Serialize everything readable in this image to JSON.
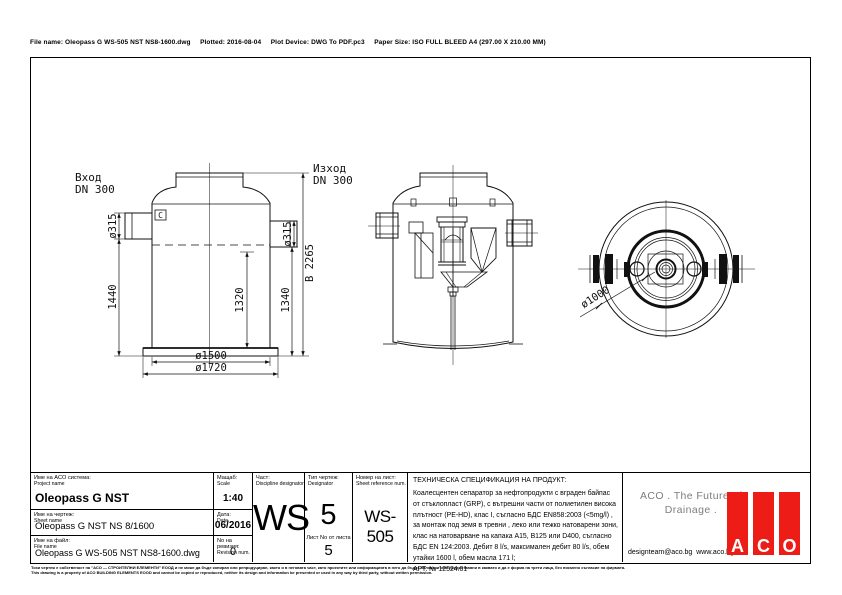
{
  "header": {
    "file_info": "File name: Oleopass G WS-505 NST NS8-1600.dwg     Plotted: 2016-08-04     Plot Device: DWG To PDF.pc3     Paper Size: ISO FULL BLEED A4 (297.00 X 210.00 MM)"
  },
  "drawing": {
    "front_view": {
      "inlet_label": "Вход",
      "inlet_dn": "DN 300",
      "outlet_label": "Изход",
      "outlet_dn": "DN 300",
      "dim_inlet_dia": "ø315",
      "dim_outlet_dia": "ø315",
      "dim_1440": "1440",
      "dim_1320": "1320",
      "dim_1340": "1340",
      "dim_total_height": "В 2265",
      "dim_inner_dia": "ø1500",
      "dim_outer_dia": "ø1720",
      "marker": "C"
    },
    "top_view": {
      "dim_dia": "ø1000"
    }
  },
  "title_block": {
    "project": {
      "label_bg": "Име на ACO система:",
      "label_en": "Project name",
      "value": "Oleopass G NST"
    },
    "sheet": {
      "label_bg": "Име на чертеж:",
      "label_en": "Sheet name",
      "value": "Oleopass G NST NS 8/1600"
    },
    "file": {
      "label_bg": "Име на файл:",
      "label_en": "File name",
      "value": "Oleopass G WS-505 NST NS8-1600.dwg"
    },
    "scale": {
      "label_bg": "Мащаб:",
      "label_en": "Scale",
      "value": "1:40"
    },
    "date": {
      "label_bg": "Дата:",
      "label_en": "Date",
      "value": "06/2016"
    },
    "revision": {
      "label_bg": "No на ревизия:",
      "label_en": "Revision num.",
      "value": "0"
    },
    "discipline": {
      "label_bg": "Част:",
      "label_en": "Discipline designator",
      "value": "WS"
    },
    "type": {
      "label_bg": "Тип чертеж:",
      "label_en": "Designator",
      "value": "5",
      "sheet_of_label": "Лист No от листа",
      "sheet_of_value": "5"
    },
    "sheet_ref": {
      "label_bg": "Номер на лист:",
      "label_en": "Sheet reference num.",
      "value": "WS-505"
    },
    "spec": {
      "title": "ТЕХНИЧЕСКА СПЕЦИФИКАЦИЯ НА ПРОДУКТ:",
      "body": "Коалесцентен сепаратор за нефтопродукти с вграден байпас от стъклопласт (GRP), с вътрешни части от полиетилен висока плътност (PE-HD), клас I, съгласно БДС EN858:2003 (<5mg/l) , за монтаж под земя в тревни , леко или тежко натоварени зони, клас на натоварване на капака A15, B125 или D400, съгласно БДС EN 124:2003. Дебит 8 l/s, максимален дебит 80 l/s, обем утайки 1600 l, обем масла 171 l;",
      "art": "АРТ. № 12524.01"
    },
    "brand": {
      "slogan_line1": "ACO . The Future of",
      "slogan_line2": "Drainage .",
      "contacts": "designteam@aco.bg  www.aco.bg",
      "logo_letters": [
        "A",
        "C",
        "O"
      ],
      "logo_color": "#ed1c16",
      "slogan_color": "#7d7d7d"
    }
  },
  "footer": {
    "disclaimer_bg": "Този чертеж е собственост на \"АСО — СТРОИТЕЛНИ ЕЛЕМЕНТИ\" ЕООД и не може да бъде копиран или репродуциран, както и в неговата част, като проектите или информацията в него да бъдат ползвани или предоставяни в каквато и да е форма на трети лица, без писмено съгласие на фирмата.",
    "disclaimer_en": "This drawing is a property of ACO BUILDING ELEMENTS EOOD and cannot be copied or reproduced, neither its design and information be presented or used in any way by third party, without written permission."
  }
}
